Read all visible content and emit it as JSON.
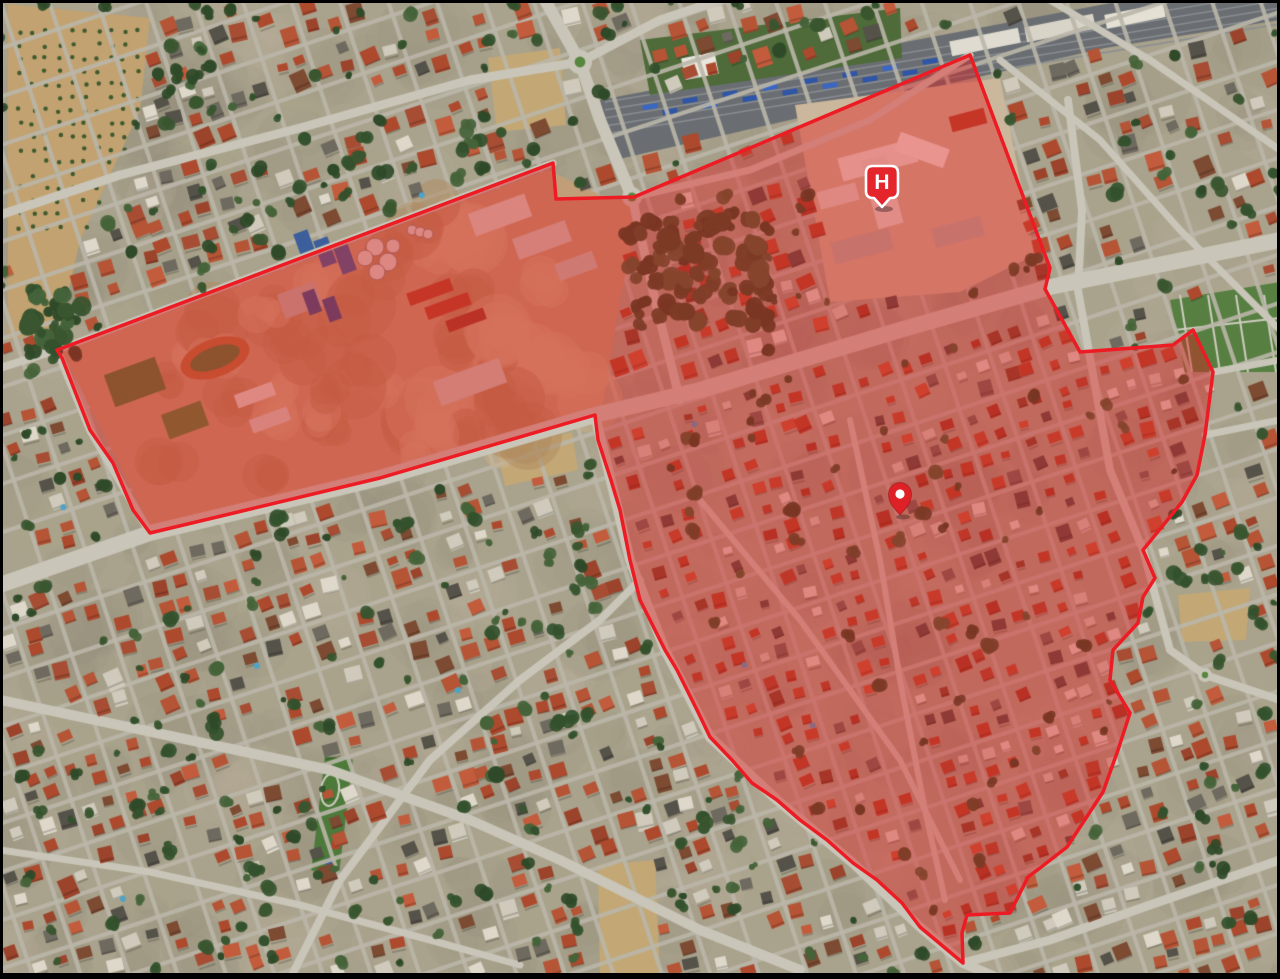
{
  "map": {
    "view_type": "satellite",
    "region_overlay": {
      "name": "highlighted-region",
      "fill_color": "#e31a1c",
      "fill_opacity": 0.42,
      "border_color": "#ed1c24",
      "border_width": 3.5,
      "polygon": [
        [
          57,
          350
        ],
        [
          553,
          163
        ],
        [
          556,
          199
        ],
        [
          634,
          197
        ],
        [
          970,
          55
        ],
        [
          1050,
          268
        ],
        [
          1045,
          289
        ],
        [
          1080,
          352
        ],
        [
          1173,
          345
        ],
        [
          1193,
          330
        ],
        [
          1213,
          372
        ],
        [
          1205,
          435
        ],
        [
          1197,
          475
        ],
        [
          1182,
          502
        ],
        [
          1143,
          550
        ],
        [
          1155,
          578
        ],
        [
          1143,
          597
        ],
        [
          1138,
          623
        ],
        [
          1113,
          650
        ],
        [
          1110,
          680
        ],
        [
          1130,
          713
        ],
        [
          1118,
          750
        ],
        [
          1103,
          792
        ],
        [
          1067,
          847
        ],
        [
          1040,
          868
        ],
        [
          1028,
          877
        ],
        [
          1010,
          913
        ],
        [
          967,
          915
        ],
        [
          962,
          933
        ],
        [
          963,
          963
        ],
        [
          920,
          927
        ],
        [
          902,
          903
        ],
        [
          877,
          880
        ],
        [
          853,
          863
        ],
        [
          827,
          840
        ],
        [
          800,
          820
        ],
        [
          777,
          800
        ],
        [
          752,
          783
        ],
        [
          732,
          760
        ],
        [
          710,
          737
        ],
        [
          697,
          710
        ],
        [
          677,
          670
        ],
        [
          665,
          650
        ],
        [
          640,
          600
        ],
        [
          630,
          560
        ],
        [
          620,
          510
        ],
        [
          610,
          477
        ],
        [
          598,
          440
        ],
        [
          595,
          415
        ],
        [
          380,
          478
        ],
        [
          150,
          533
        ],
        [
          133,
          510
        ],
        [
          113,
          463
        ],
        [
          90,
          430
        ],
        [
          62,
          358
        ]
      ]
    },
    "markers": [
      {
        "id": "hospital",
        "type": "hospital",
        "label": "H",
        "anchor_x": 882,
        "anchor_y": 207,
        "color": "#e4262c",
        "border_color": "#ffffff"
      },
      {
        "id": "destination",
        "type": "location-pin",
        "label": "",
        "anchor_x": 900,
        "anchor_y": 515,
        "color": "#de2127",
        "inner_dot_color": "#ffffff"
      }
    ],
    "base_palette": {
      "ground": "#a9a28c",
      "road": "#c9c6b9",
      "roof_terracotta": "#ad4a2e",
      "roof_light": "#ddd8ca",
      "vegetation": "#3a5630",
      "bare_field": "#c2a271",
      "railway": "#6a6e72",
      "pool_water": "#4fa3c7"
    },
    "frame_color": "#000000"
  }
}
